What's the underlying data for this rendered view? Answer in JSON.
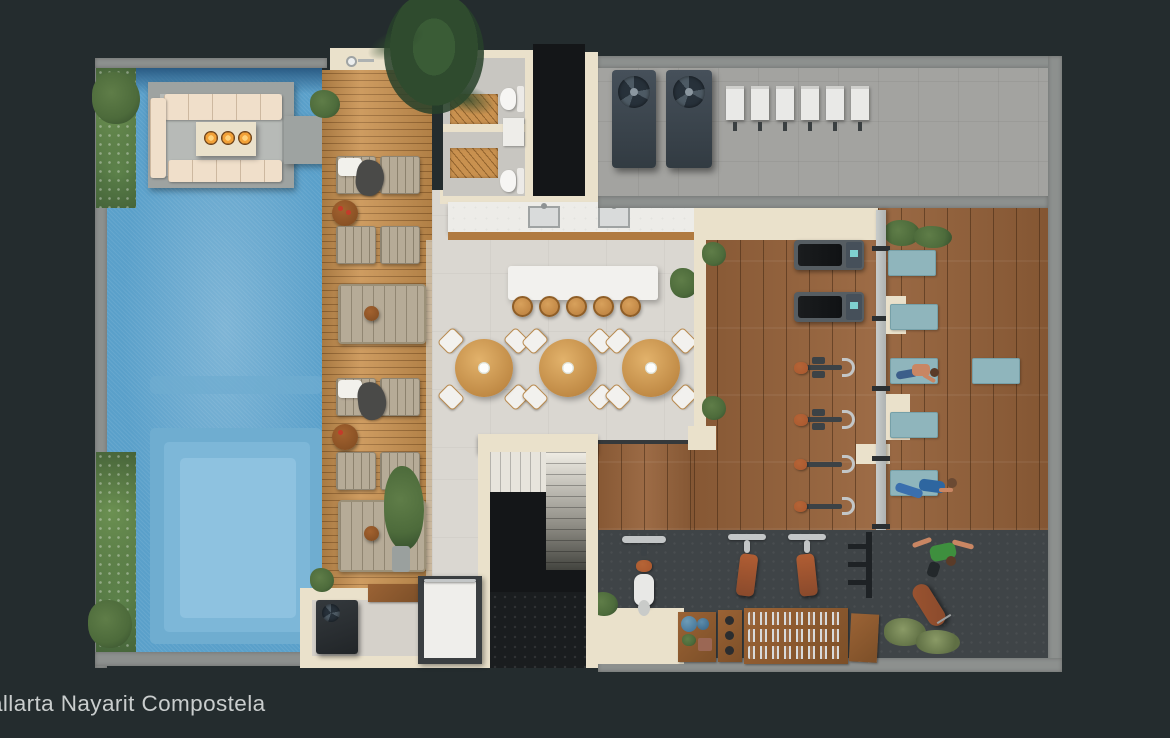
{
  "caption": {
    "text": "allarta Nayarit Compostela"
  },
  "scene": {
    "type": "floor-plan-render",
    "areas": [
      "pool",
      "fire-pit-lounge",
      "sun-deck",
      "restrooms",
      "outdoor-kitchen",
      "bar-island",
      "dining-terrace",
      "utility-room",
      "fitness-center",
      "yoga-area",
      "weights-area",
      "stairwell",
      "elevator",
      "boxing-corner"
    ]
  },
  "palette": {
    "bg": "#242c2e",
    "wall": "#8d908e",
    "cream": "#eae1cb",
    "pool": "#5aa0ca",
    "pool_dark": "#2a5b84",
    "pool_shelf_mid": "#6fadd0",
    "pool_shelf": "#7db7d8",
    "pool_shelf_light": "#8ec2e0",
    "platform": "#9ea3a1",
    "sofa": "#f0dfca",
    "flame": "#f2a138",
    "deck_wood": "#c9914f",
    "gym_wood": "#96623a",
    "wood_dark": "#7c4f28",
    "cushion": "#b6ab97",
    "terrace": "#dad7d1",
    "marble": "#edece8",
    "white": "#f2f1ee",
    "bath_floor": "#c8c6c1",
    "void": "#141618",
    "util_floor": "#a3a3a0",
    "rubber": "#3f4447",
    "mat": "#8fb5bc",
    "mat_edge": "#76a0a8",
    "leather": "#a9572e",
    "leather_dark": "#8a4a2c",
    "steel": "#c3c6c7",
    "screen": "#7fd0cf",
    "green": "#4d6b3b",
    "green_dark": "#334c2c",
    "olive": "#5f6f44",
    "skin": "#c98663",
    "caption": "#c9cdcd"
  }
}
